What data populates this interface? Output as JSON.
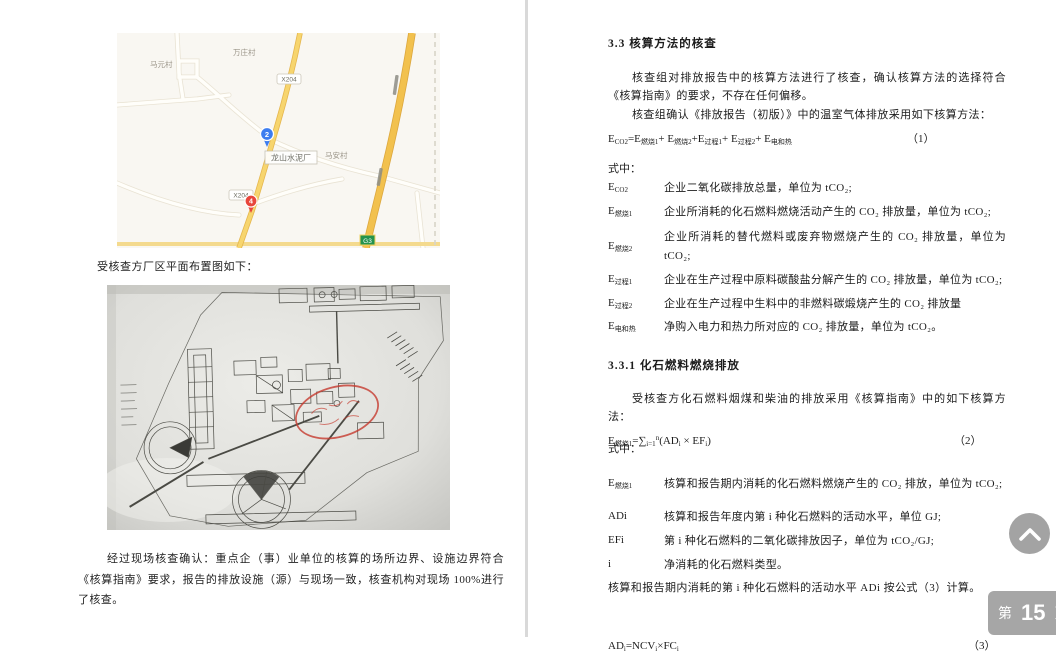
{
  "viewer": {
    "page_label_prefix": "第",
    "page_number": "15",
    "page_label_suffix": "页",
    "colors": {
      "page_badge_bg": "#a6a6a6",
      "road_yellow": "#f7d56e",
      "expressway_yellow": "#f2c14e",
      "marker_blue": "#3d7df0",
      "marker_red": "#e8463c",
      "shield_green": "#23934d",
      "stamp_red": "#c63a2e"
    }
  },
  "left_page": {
    "map": {
      "villages": {
        "top": "万庄村",
        "left": "马元村",
        "right": "马安村"
      },
      "plant_label": "龙山水泥厂",
      "road_shield": "X204",
      "expressway_shield": "G3",
      "marker_blue": "2",
      "marker_red": "4"
    },
    "caption": "受核查方厂区平面布置图如下：",
    "paragraph": "经过现场核查确认：重点企（事）业单位的核算的场所边界、设施边界符合《核算指南》要求，报告的排放设施（源）与现场一致，核查机构对现场 100%进行了核查。"
  },
  "right_page": {
    "heading1": "3.3  核算方法的核查",
    "para1": "核查组对排放报告中的核算方法进行了核查，确认核算方法的选择符合《核算指南》的要求，不存在任何偏移。",
    "para2": "核查组确认《排放报告（初版）》中的温室气体排放采用如下核算方法：",
    "formula1": {
      "expr": "E_{CO2}=E_{燃烧1}+ E_{燃烧2}+E_{过程1}+ E_{过程2}+ E_{电和热}",
      "num": "（1）"
    },
    "where1": "式中：",
    "terms1": [
      {
        "term": "E_{CO2}",
        "def": "企业二氧化碳排放总量，单位为 tCO₂;"
      },
      {
        "term": "E_{燃烧1}",
        "def": "企业所消耗的化石燃料燃烧活动产生的 CO₂ 排放量，单位为 tCO₂;"
      },
      {
        "term": "E_{燃烧2}",
        "def": "企业所消耗的替代燃料或废弃物燃烧产生的 CO₂ 排放量，单位为 tCO₂;"
      },
      {
        "term": "E_{过程1}",
        "def": "企业在生产过程中原料碳酸盐分解产生的 CO₂ 排放量，单位为 tCO₂;"
      },
      {
        "term": "E_{过程2}",
        "def": "企业在生产过程中生料中的非燃料碳煅烧产生的 CO₂ 排放量"
      },
      {
        "term": "E_{电和热}",
        "def": "净购入电力和热力所对应的 CO₂ 排放量，单位为 tCO₂。"
      }
    ],
    "heading2": "3.3.1  化石燃料燃烧排放",
    "para3": "受核查方化石燃料烟煤和柴油的排放采用《核算指南》中的如下核算方法：",
    "formula2": {
      "expr": "E_{燃烧1}=∑_{i=1}^{n}(AD_{i} × EF_{i})",
      "num": "（2）"
    },
    "where2": "式中：",
    "terms2": [
      {
        "term": "E_{燃烧1}",
        "def": "核算和报告期内消耗的化石燃料燃烧产生的 CO₂ 排放，单位为 tCO₂;"
      },
      {
        "term": "ADi",
        "def": "核算和报告年度内第 i 种化石燃料的活动水平，单位 GJ;"
      },
      {
        "term": "EFi",
        "def": "第 i 种化石燃料的二氧化碳排放因子，单位为 tCO₂/GJ;"
      },
      {
        "term": "i",
        "def": "净消耗的化石燃料类型。"
      }
    ],
    "para4": "核算和报告期内消耗的第 i 种化石燃料的活动水平 ADi 按公式（3）计算。",
    "formula3": {
      "expr": "AD_{i}=NCV_{i}×FC_{i}",
      "num": "（3）"
    }
  }
}
